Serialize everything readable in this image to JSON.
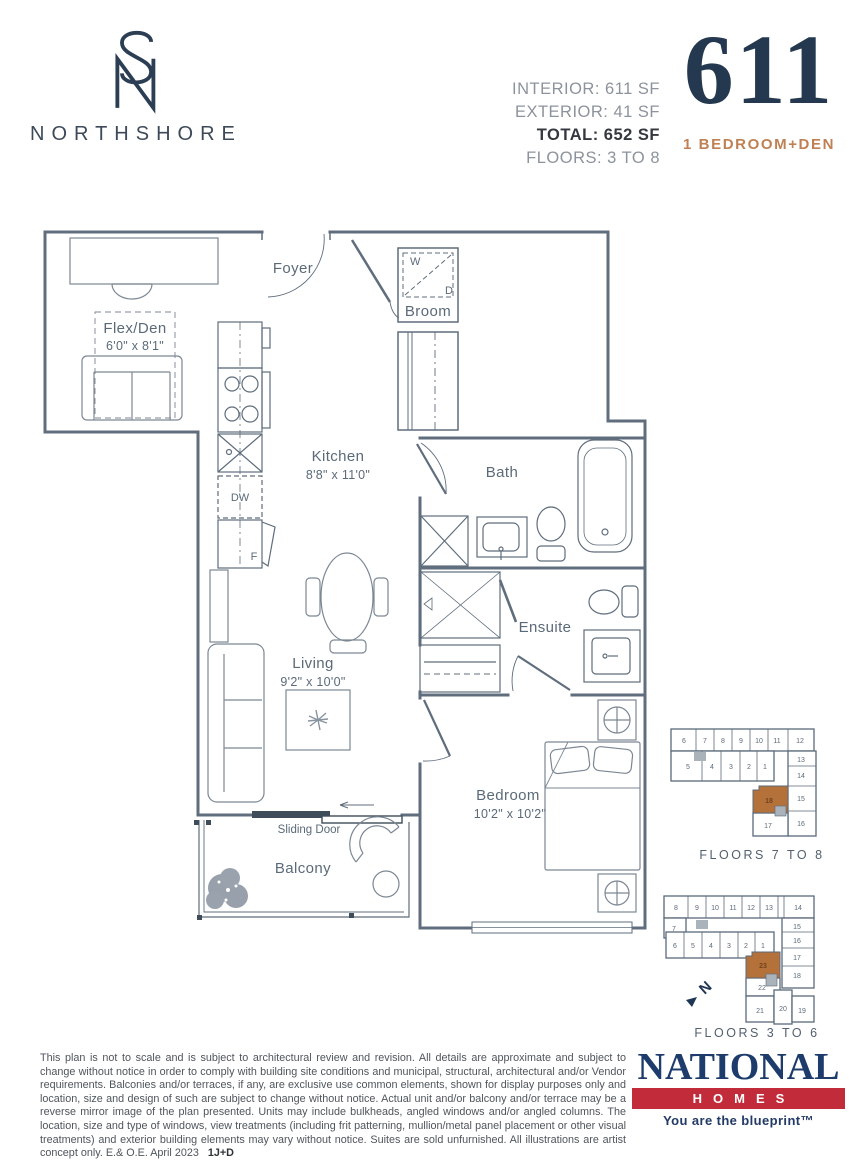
{
  "header": {
    "brand": "NORTHSHORE",
    "stats": [
      "INTERIOR: 611 SF",
      "EXTERIOR: 41 SF",
      "TOTAL: 652 SF",
      "FLOORS: 3 TO 8"
    ],
    "unit_number": "611",
    "unit_type": "1 BEDROOM+DEN"
  },
  "floorplan": {
    "rooms": {
      "foyer": {
        "name": "Foyer"
      },
      "broom": {
        "name": "Broom",
        "washer": "W",
        "dryer": "D"
      },
      "flex_den": {
        "name": "Flex/Den",
        "dims": "6'0\" x 8'1\""
      },
      "kitchen": {
        "name": "Kitchen",
        "dims": "8'8\" x 11'0\""
      },
      "bath": {
        "name": "Bath"
      },
      "living": {
        "name": "Living",
        "dims": "9'2\" x 10'0\""
      },
      "ensuite": {
        "name": "Ensuite"
      },
      "bedroom": {
        "name": "Bedroom",
        "dims": "10'2\" x 10'2\""
      },
      "balcony": {
        "name": "Balcony"
      },
      "sliding_door": {
        "name": "Sliding Door"
      }
    },
    "appliances": {
      "dishwasher": "DW",
      "fridge": "F"
    }
  },
  "keyplans": [
    {
      "caption": "FLOORS 7 TO 8",
      "highlight_unit": "18",
      "units": [
        "6",
        "7",
        "8",
        "9",
        "10",
        "11",
        "12",
        "5",
        "4",
        "3",
        "2",
        "1",
        "13",
        "14",
        "15",
        "16",
        "18",
        "17"
      ]
    },
    {
      "caption": "FLOORS 3 TO 6",
      "highlight_unit": "23",
      "north_label": "N",
      "units": [
        "8",
        "9",
        "10",
        "11",
        "12",
        "13",
        "14",
        "7",
        "6",
        "5",
        "4",
        "3",
        "2",
        "1",
        "15",
        "16",
        "17",
        "18",
        "23",
        "22",
        "21",
        "20",
        "19"
      ]
    }
  ],
  "footer": {
    "disclaimer": "This plan is not to scale and is subject to architectural review and revision. All details are approximate and subject to change without notice in order to comply with building site conditions and municipal, structural, architectural and/or Vendor requirements. Balconies and/or terraces, if any, are exclusive use common elements, shown for display purposes only and location, size and design of such are subject to change without notice. Actual unit and/or balcony and/or terrace may be a reverse mirror image of the plan presented. Units may include bulkheads, angled windows and/or angled columns. The location, size and type of windows, view treatments (including frit patterning, mullion/metal panel placement or other visual treatments) and exterior building elements may vary without notice. Suites are sold unfurnished. All illustrations are artist concept only. E.& O.E. April 2023",
    "plan_code": "1J+D",
    "builder": {
      "name": "NATIONAL",
      "homes": "HOMES",
      "tagline": "You are the blueprint™"
    }
  },
  "colors": {
    "navy": "#24384f",
    "copper": "#bf8154",
    "plan_line": "#5f6d7c",
    "keyplan_highlight": "#b5713a",
    "national_navy": "#1d3c6b",
    "national_red": "#c22b39"
  }
}
